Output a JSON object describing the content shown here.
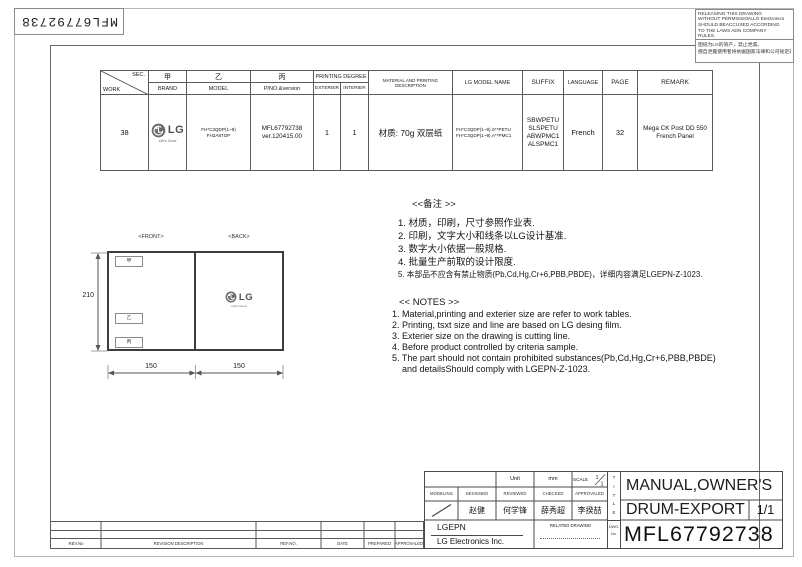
{
  "sheet": {
    "barcode_label": "MFL67792738",
    "warning": {
      "en_lines": [
        "RELEASING THIS DRAWING",
        "WITHOUT PERMISSION,LG Electronics",
        "SHOULD BEACCUSED ACCORDING",
        "TO THE LAWS ADN COMPANY",
        "RULES."
      ],
      "cn_lines": [
        "图纸为LG的资产，禁止泄漏。",
        "擅自泄露使用者将依据国家法律和公司规定处罚。"
      ]
    }
  },
  "work_table": {
    "headers": {
      "sec": "SEC.",
      "work": "WORK",
      "brand_cn": "甲",
      "brand": "BRAND",
      "model_cn": "乙",
      "model": "MODEL",
      "pno_cn": "丙",
      "pno": "P/NO.&version",
      "printing_degree": "PRINTING DEGREE",
      "exterier": "EXTERIER",
      "interier": "INTERIER",
      "material": "MATERIAL AND PRINTING DESCRIPTION",
      "lg_model_name": "LG MODEL NAME",
      "suffix": "SUFFIX",
      "language": "LANGUAGE",
      "page": "PAGE",
      "remark": "REMARK"
    },
    "row": {
      "work": "38",
      "brand_logo_text": "LG",
      "brand_tagline": "Life's Good",
      "model_lines": [
        "FH*C3QDP(1~9)",
        "FH2A8TDP"
      ],
      "pno_lines": [
        "MFL67792738",
        "ver.120415.00"
      ],
      "exterier": "1",
      "interier": "1",
      "material": "材质: 70g 双层纸",
      "lg_model_lines": [
        "FH*C3QDP(1~9).S**PETU",
        "FH*C3QDP(1~9).A**PMC1"
      ],
      "suffix_lines": [
        "SBWPETU",
        "SLSPETU",
        "ABWPMC1",
        "ALSPMC1"
      ],
      "language": "French",
      "page": "32",
      "remark_lines": [
        "Mega CK Post DD 550",
        "French Panel"
      ]
    }
  },
  "notes_cn": {
    "title": "<<备注 >>",
    "items": [
      "1.  材质，印刷，尺寸参照作业表.",
      "2.  印刷，文字大小和线条以LG设计基准.",
      "3.  数字大小依据一般规格.",
      "4.  批量生产前取的设计限度.",
      "5.  本部品不应含有禁止物质(Pb,Cd,Hg,Cr+6,PBB,PBDE)，详细内容满足LGEPN-Z-1023."
    ]
  },
  "notes_en": {
    "title": "<< NOTES >>",
    "items": [
      "1. Material,printing and exterier size are refer to work tables.",
      "2. Printing, tsxt  size and line are based on LG desing film.",
      "3. Exterier size on the drawing is cutting line.",
      "4. Before product controlled by criteria sample.",
      "5. The part should not contain prohibited substances(Pb,Cd,Hg,Cr+6,PBB,PBDE)",
      "and detailsShould comply with LGEPN-Z-1023."
    ]
  },
  "drawing": {
    "front_label": "<FRONT>",
    "back_label": "<BACK>",
    "height_dim": "210",
    "width_dim_left": "150",
    "width_dim_right": "150",
    "area_labels": [
      "甲",
      "乙",
      "丙"
    ],
    "logo_text": "LG",
    "logo_tagline": "Life's Good"
  },
  "title_block": {
    "unit_label": "Unit",
    "unit_value": "mm",
    "scale_label": "SCALE",
    "scale_num": "1",
    "scale_den": "1",
    "col_labels": [
      "MODELING",
      "DESIGNED",
      "REVIEWED",
      "CHECKED",
      "APPROVALED"
    ],
    "designed_by": "赵健",
    "reviewed_by": "何学锋",
    "checked_by": "薛秀超",
    "approved_by": "李揆喆",
    "company_short": "LGEPN",
    "company_full": "LG Electronics Inc.",
    "related_drawing": "RELATED DRAWING",
    "title_letters": [
      "T",
      "I",
      "T",
      "L",
      "E"
    ],
    "dwg_label_top": "DWG.",
    "dwg_label_bottom": "No.",
    "product_title": "MANUAL,OWNER'S",
    "product_subtitle": "DRUM-EXPORT",
    "sheet_no": "1/1",
    "dwg_no": "MFL67792738"
  },
  "revision_table": {
    "headers": [
      "REV.No",
      "REVISION DESCRIPTION",
      "REF.NO.",
      "DATE",
      "PREPARED",
      "APPROVALED"
    ]
  },
  "colors": {
    "line_dark": "#4a4a4a",
    "line_mid": "#8a8a8a",
    "lg_gray": "#6a6a6a"
  }
}
